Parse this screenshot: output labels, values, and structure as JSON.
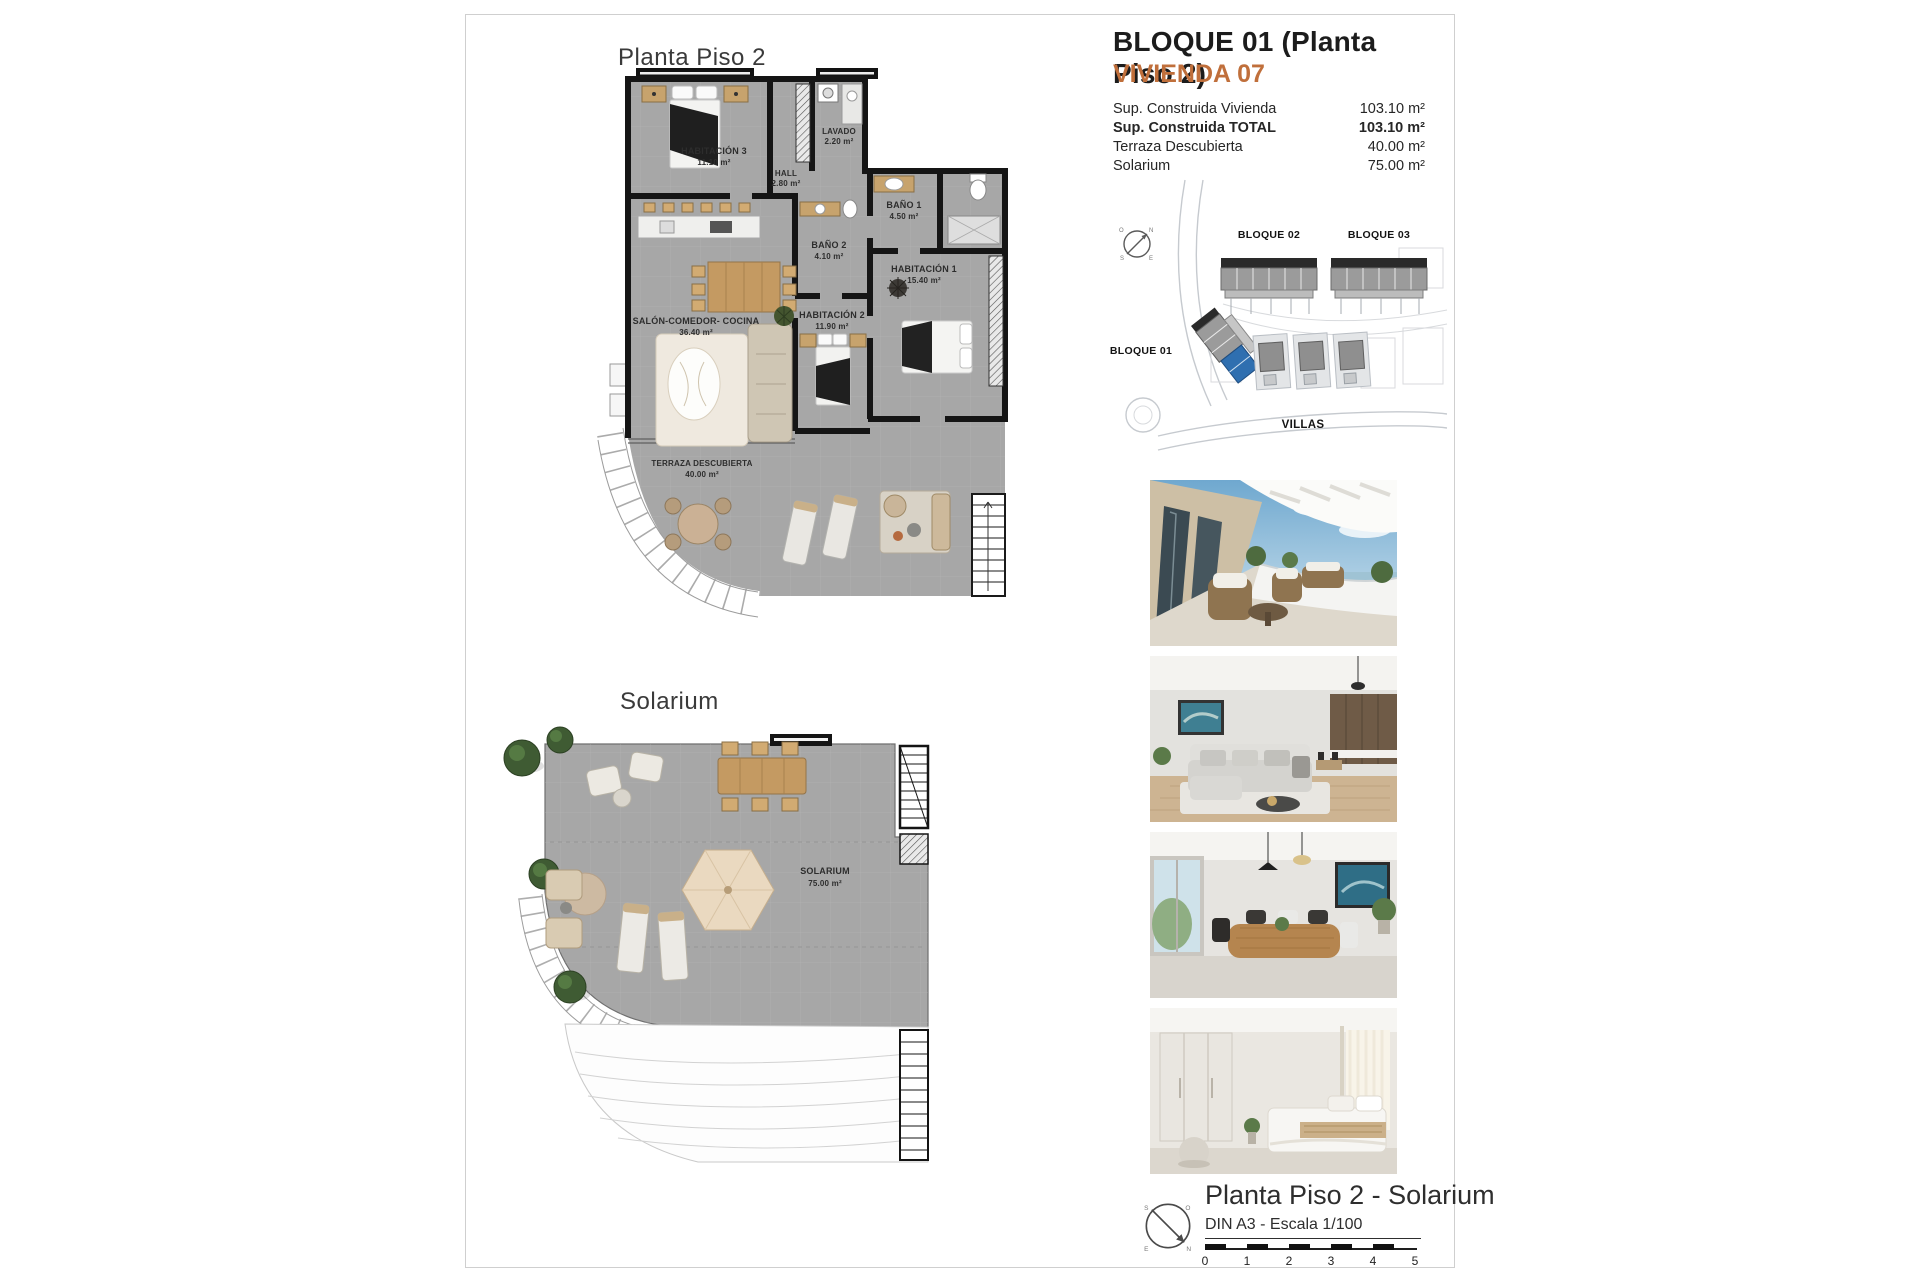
{
  "header": {
    "title": "BLOQUE 01  (Planta Piso 2)",
    "subtitle": "VIVIENDA 07",
    "accent_color": "#c06f3b",
    "rows": [
      {
        "label": "Sup. Construida Vivienda",
        "value": "103.10 m²"
      },
      {
        "label": "Sup. Construida TOTAL",
        "value": "103.10 m²"
      },
      {
        "label": "Terraza Descubierta",
        "value": "40.00 m²"
      },
      {
        "label": "Solarium",
        "value": "75.00 m²"
      }
    ]
  },
  "plans": {
    "plan1_title": "Planta Piso 2",
    "plan2_title": "Solarium",
    "rooms": {
      "hab3": {
        "name": "HABITACIÓN 3",
        "area": "11.10 m²"
      },
      "hall": {
        "name": "HALL",
        "area": "2.80 m²"
      },
      "lavado": {
        "name": "LAVADO",
        "area": "2.20 m²"
      },
      "bano2": {
        "name": "BAÑO 2",
        "area": "4.10 m²"
      },
      "bano1": {
        "name": "BAÑO 1",
        "area": "4.50 m²"
      },
      "hab1": {
        "name": "HABITACIÓN 1",
        "area": "15.40 m²"
      },
      "hab2": {
        "name": "HABITACIÓN 2",
        "area": "11.90 m²"
      },
      "salon": {
        "name": "SALÓN-COMEDOR- COCINA",
        "area": "36.40 m²"
      },
      "terraza": {
        "name": "TERRAZA DESCUBIERTA",
        "area": "40.00 m²"
      },
      "solarium": {
        "name": "SOLARIUM",
        "area": "75.00 m²"
      }
    }
  },
  "site_plan": {
    "bloque01": "BLOQUE 01",
    "bloque02": "BLOQUE 02",
    "bloque03": "BLOQUE 03",
    "villas": "VILLAS",
    "highlight_color": "#2f6fb0"
  },
  "photos": [
    "terrace-balcony-sea-view",
    "living-room-sofa",
    "dining-area-table",
    "bedroom-bed-wardrobe"
  ],
  "footer": {
    "title": "Planta Piso 2 - Solarium",
    "scale_label": "DIN A3 - Escala 1/100",
    "ticks": [
      "0",
      "1",
      "2",
      "3",
      "4",
      "5"
    ],
    "compass_points": [
      "N",
      "S",
      "E",
      "O"
    ]
  }
}
